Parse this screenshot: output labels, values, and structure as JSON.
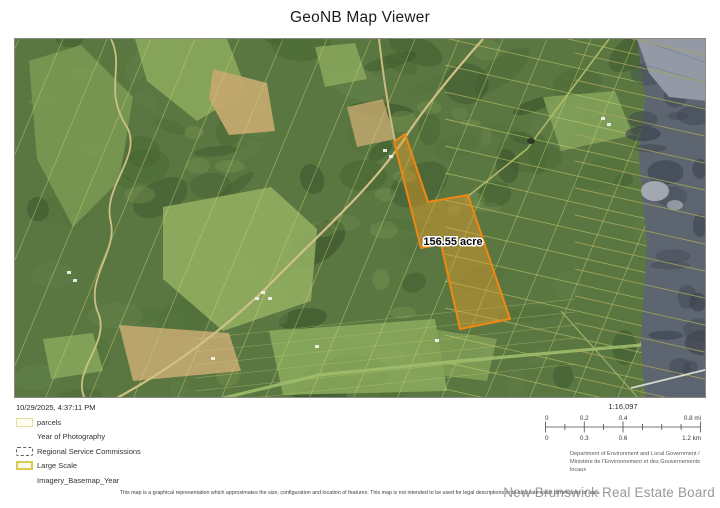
{
  "title": "GeoNB Map Viewer",
  "map": {
    "parcel_label": "156.55 acre",
    "timestamp": "10/29/2025, 4:37:11 PM"
  },
  "legend": {
    "items": [
      {
        "label": "parcels",
        "swatch": "parcels-outline-icon"
      },
      {
        "label": "Year of Photography",
        "swatch": "none"
      },
      {
        "label": "Regional Service Commissions",
        "swatch": "dashed-outline-icon"
      },
      {
        "label": "Large Scale",
        "swatch": "yellow-outline-icon"
      },
      {
        "label": "Imagery_Basemap_Year",
        "swatch": "none"
      }
    ]
  },
  "scale": {
    "ratio": "1:16,097",
    "mi_labels": [
      "0",
      "0.2",
      "0.4",
      "0.8 mi"
    ],
    "km_labels": [
      "0",
      "0.3",
      "0.6",
      "1.2 km"
    ]
  },
  "attribution": "Department of Environment and Local Government / Ministère de l'Environnement et des Gouvernements locaux",
  "disclaimer": "This map is a graphical representation which approximates the size, configuration and location of features. This map is not intended to be used for legal descriptions or to calculate exact dimensions of area.",
  "watermark": "New Brunswick Real Estate Board",
  "colors": {
    "parcel_outline": "#ef8712",
    "parcel_fill": "rgba(240,160,40,0.42)",
    "parcel_boundary_lines": "#d2d270",
    "legend_yellow": "#d9cb52"
  }
}
